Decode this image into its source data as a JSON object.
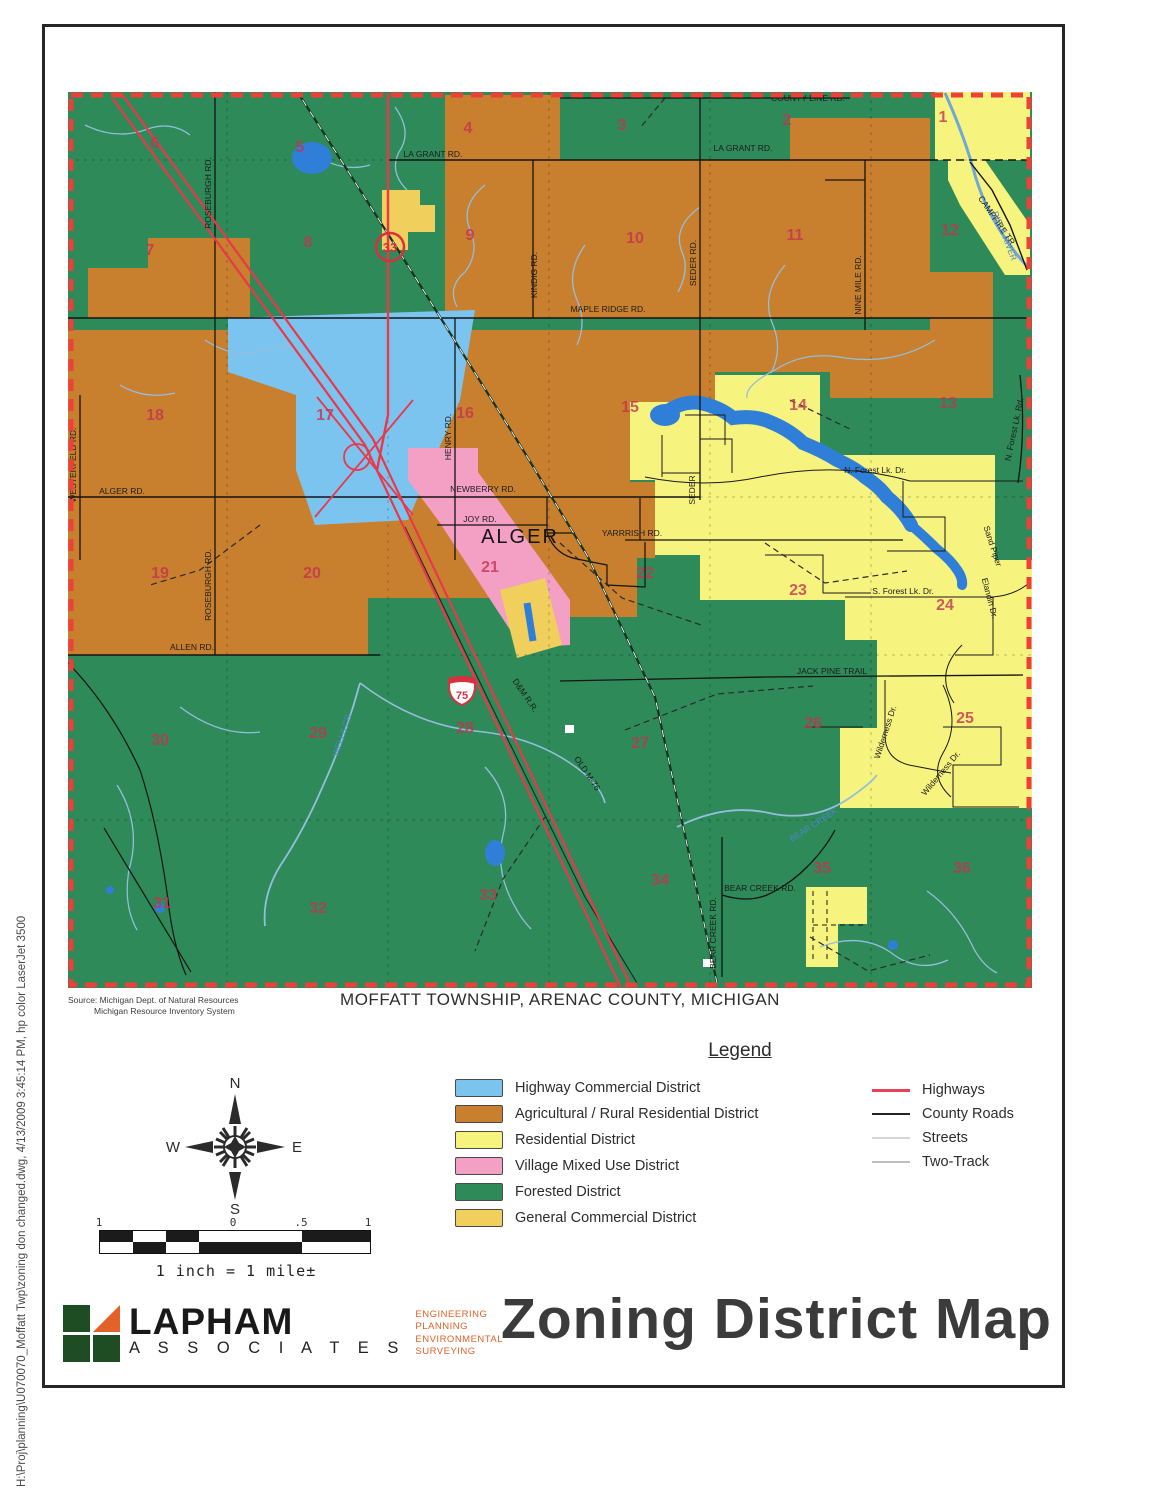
{
  "sidebar_text": "H:\\Proj\\planning\\U070070_Moffatt Twp\\zoning don changed.dwg, 4/13/2009 3:45:14 PM, hp color LaserJet 3500",
  "map": {
    "subtitle": "MOFFATT TOWNSHIP, ARENAC COUNTY, MICHIGAN",
    "source_line1": "Source:  Michigan Dept. of Natural Resources",
    "source_line2": "Michigan Resource Inventory System",
    "town_label": "ALGER",
    "interstate_shield": "75",
    "route_circle": "33",
    "section_numbers": [
      {
        "n": "6",
        "x": 90,
        "y": 63
      },
      {
        "n": "5",
        "x": 235,
        "y": 67
      },
      {
        "n": "4",
        "x": 403,
        "y": 48
      },
      {
        "n": "3",
        "x": 557,
        "y": 45
      },
      {
        "n": "2",
        "x": 722,
        "y": 40
      },
      {
        "n": "1",
        "x": 878,
        "y": 37
      },
      {
        "n": "7",
        "x": 85,
        "y": 170
      },
      {
        "n": "8",
        "x": 243,
        "y": 162
      },
      {
        "n": "9",
        "x": 405,
        "y": 155
      },
      {
        "n": "10",
        "x": 570,
        "y": 158
      },
      {
        "n": "11",
        "x": 730,
        "y": 155
      },
      {
        "n": "12",
        "x": 885,
        "y": 150
      },
      {
        "n": "18",
        "x": 90,
        "y": 335
      },
      {
        "n": "17",
        "x": 260,
        "y": 335
      },
      {
        "n": "16",
        "x": 400,
        "y": 333
      },
      {
        "n": "15",
        "x": 565,
        "y": 327
      },
      {
        "n": "14",
        "x": 733,
        "y": 325
      },
      {
        "n": "13",
        "x": 883,
        "y": 323
      },
      {
        "n": "19",
        "x": 95,
        "y": 493
      },
      {
        "n": "20",
        "x": 247,
        "y": 493
      },
      {
        "n": "21",
        "x": 425,
        "y": 487
      },
      {
        "n": "22",
        "x": 580,
        "y": 493
      },
      {
        "n": "23",
        "x": 733,
        "y": 510
      },
      {
        "n": "24",
        "x": 880,
        "y": 525
      },
      {
        "n": "30",
        "x": 95,
        "y": 660
      },
      {
        "n": "29",
        "x": 253,
        "y": 653
      },
      {
        "n": "28",
        "x": 400,
        "y": 648
      },
      {
        "n": "27",
        "x": 575,
        "y": 663
      },
      {
        "n": "26",
        "x": 748,
        "y": 643
      },
      {
        "n": "25",
        "x": 900,
        "y": 638
      },
      {
        "n": "31",
        "x": 97,
        "y": 823
      },
      {
        "n": "32",
        "x": 253,
        "y": 828
      },
      {
        "n": "33",
        "x": 423,
        "y": 815
      },
      {
        "n": "34",
        "x": 595,
        "y": 800
      },
      {
        "n": "35",
        "x": 757,
        "y": 788
      },
      {
        "n": "36",
        "x": 897,
        "y": 788
      }
    ],
    "road_labels": [
      {
        "text": "COUNTY LINE RD.",
        "x": 743,
        "y": 16,
        "rot": 0
      },
      {
        "text": "LA GRANT RD.",
        "x": 368,
        "y": 72,
        "rot": 0
      },
      {
        "text": "LA GRANT RD.",
        "x": 678,
        "y": 66,
        "rot": 0
      },
      {
        "text": "MAPLE RIDGE RD.",
        "x": 543,
        "y": 227,
        "rot": 0
      },
      {
        "text": "ALGER RD.",
        "x": 57,
        "y": 409,
        "rot": 0
      },
      {
        "text": "NEWBERRY RD.",
        "x": 418,
        "y": 407,
        "rot": 0
      },
      {
        "text": "JOY RD.",
        "x": 415,
        "y": 437,
        "rot": 0
      },
      {
        "text": "YARRRISH RD.",
        "x": 567,
        "y": 451,
        "rot": 0
      },
      {
        "text": "ALLEN RD.",
        "x": 127,
        "y": 565,
        "rot": 0
      },
      {
        "text": "JACK PINE TRAIL",
        "x": 767,
        "y": 589,
        "rot": 0
      },
      {
        "text": "BEAR CREEK RD.",
        "x": 695,
        "y": 806,
        "rot": 0
      },
      {
        "text": "BEAR CREEK RD.",
        "x": 651,
        "y": 848,
        "rot": -90
      },
      {
        "text": "ROSEBURGH RD.",
        "x": 146,
        "y": 108,
        "rot": -90
      },
      {
        "text": "ROSEBURGH RD.",
        "x": 146,
        "y": 500,
        "rot": -90
      },
      {
        "text": "WESTERFELD RD.",
        "x": 11,
        "y": 380,
        "rot": -90
      },
      {
        "text": "HENRY RD.",
        "x": 386,
        "y": 352,
        "rot": -90
      },
      {
        "text": "KINDIG RD.",
        "x": 472,
        "y": 190,
        "rot": -90
      },
      {
        "text": "SEDER RD.",
        "x": 631,
        "y": 178,
        "rot": -90
      },
      {
        "text": "SEDER",
        "x": 630,
        "y": 405,
        "rot": -90
      },
      {
        "text": "NINE MILE RD.",
        "x": 796,
        "y": 200,
        "rot": -90
      },
      {
        "text": "N. Forest Lk. Rd.",
        "x": 952,
        "y": 345,
        "rot": -78
      },
      {
        "text": "CAMPFIRE TR.",
        "x": 930,
        "y": 138,
        "rot": 55
      },
      {
        "text": "N. Forest Lk. Dr.",
        "x": 810,
        "y": 388,
        "rot": 0
      },
      {
        "text": "S. Forest Lk. Dr.",
        "x": 838,
        "y": 509,
        "rot": 0
      },
      {
        "text": "Sand Piper",
        "x": 925,
        "y": 462,
        "rot": 72
      },
      {
        "text": "Elandin Dr.",
        "x": 922,
        "y": 514,
        "rot": 75
      },
      {
        "text": "Wilderness Dr.",
        "x": 823,
        "y": 648,
        "rot": -72
      },
      {
        "text": "Wilderness Dr.",
        "x": 878,
        "y": 690,
        "rot": -50
      },
      {
        "text": "D&M R.R.",
        "x": 458,
        "y": 612,
        "rot": 56
      },
      {
        "text": "OLD M-76",
        "x": 520,
        "y": 690,
        "rot": 56
      }
    ],
    "water_labels": [
      {
        "text": "RIFLE RIVER",
        "x": 937,
        "y": 152,
        "rot": 68
      },
      {
        "text": "WELLS CR.",
        "x": 280,
        "y": 650,
        "rot": -72
      },
      {
        "text": "BEAR CREEK",
        "x": 750,
        "y": 742,
        "rot": -33
      }
    ]
  },
  "legend": {
    "title": "Legend",
    "districts": [
      {
        "label": "Highway Commercial District",
        "color": "#7cc4f0"
      },
      {
        "label": "Agricultural / Rural Residential District",
        "color": "#c87f2e"
      },
      {
        "label": "Residential District",
        "color": "#f7f37f"
      },
      {
        "label": "Village Mixed Use District",
        "color": "#f49fc4"
      },
      {
        "label": "Forested District",
        "color": "#2e8a58"
      },
      {
        "label": "General Commercial District",
        "color": "#f0cf5c"
      }
    ],
    "lines": [
      {
        "label": "Highways",
        "color": "#e8415a",
        "weight": 3
      },
      {
        "label": "County Roads",
        "color": "#222222",
        "weight": 2
      },
      {
        "label": "Streets",
        "color": "#d6d6d6",
        "weight": 2
      },
      {
        "label": "Two-Track",
        "color": "#bfbfbf",
        "weight": 2
      }
    ]
  },
  "compass": {
    "north": "N",
    "south": "S",
    "east": "E",
    "west": "W"
  },
  "scale": {
    "ticks": [
      {
        "t": "1",
        "x": 3
      },
      {
        "t": "0",
        "x": 137
      },
      {
        "t": ".5",
        "x": 205
      },
      {
        "t": "1",
        "x": 272
      }
    ],
    "caption": "1 inch = 1 mile±"
  },
  "logo": {
    "name": "LAPHAM",
    "sub": "A S S O C I A T E S",
    "services": [
      "ENGINEERING",
      "PLANNING",
      "ENVIRONMENTAL",
      "SURVEYING"
    ]
  },
  "title": "Zoning District Map",
  "colors": {
    "highway_commercial": "#7cc4f0",
    "agricultural": "#c87f2e",
    "residential": "#f7f37f",
    "village_mixed_use": "#f49fc4",
    "forested": "#2e8a58",
    "general_commercial": "#f0cf5c",
    "highways": "#e8394a",
    "water": "#2f7fd8",
    "map_border": "#ee3f38",
    "section_number": "#c53352"
  }
}
